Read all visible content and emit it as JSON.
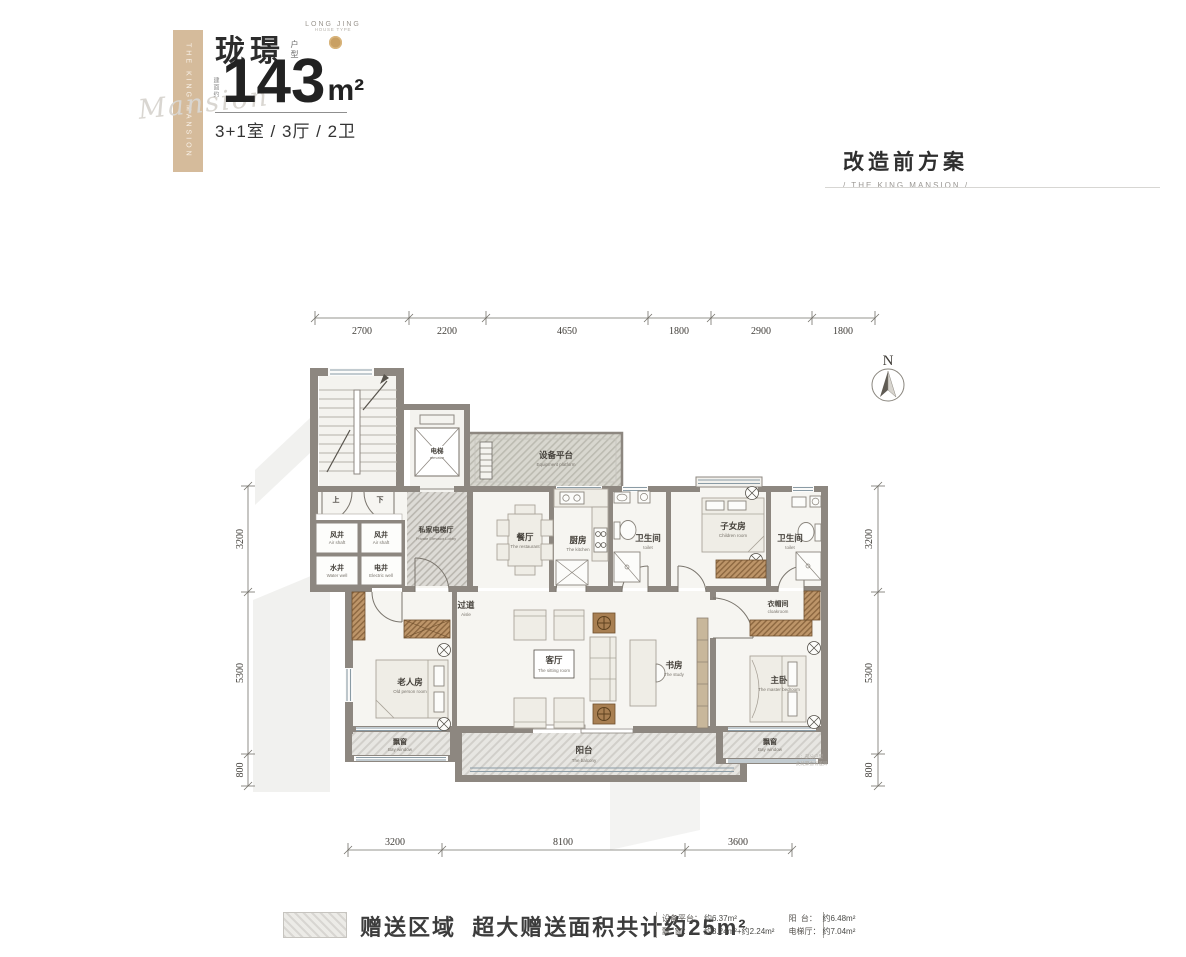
{
  "header": {
    "brand": "珑璟",
    "brand_tag": "户型",
    "area_prefix": "建面约",
    "area": "143",
    "area_unit": "m²",
    "layout": "3+1室 / 3厅 / 2卫",
    "logo_line1": "LONG JING",
    "logo_line2": "HOUSE TYPE",
    "ribbon_text": "THE KING MANSION",
    "script_text": "Mansion",
    "accent_color": "#d5bb9b",
    "gold_color": "#c9a063"
  },
  "title": {
    "main": "改造前方案",
    "sub": "/ THE KING MANSION /"
  },
  "north_label": "N",
  "dimensions": {
    "top": [
      "2700",
      "2200",
      "4650",
      "1800",
      "2900",
      "1800"
    ],
    "bottom": [
      "3200",
      "8100",
      "3600"
    ],
    "left": [
      "3200",
      "5300",
      "800"
    ],
    "right": [
      "3200",
      "5300",
      "800"
    ]
  },
  "rooms": {
    "air_shaft_1": {
      "zh": "风井",
      "en": "Air shaft"
    },
    "air_shaft_2": {
      "zh": "风井",
      "en": "Air shaft"
    },
    "water_well": {
      "zh": "水井",
      "en": "Water well"
    },
    "electric_well": {
      "zh": "电井",
      "en": "Electric well"
    },
    "elevator": {
      "zh": "电梯",
      "en": "elevator"
    },
    "lobby": {
      "zh": "私家电梯厅",
      "en": "Private Elevator Lobby"
    },
    "equipment": {
      "zh": "设备平台",
      "en": "Equipment platform"
    },
    "dining": {
      "zh": "餐厅",
      "en": "The restaurant"
    },
    "kitchen": {
      "zh": "厨房",
      "en": "The kitchen"
    },
    "bath_1": {
      "zh": "卫生间",
      "en": "toilet"
    },
    "children": {
      "zh": "子女房",
      "en": "Children room"
    },
    "bath_2": {
      "zh": "卫生间",
      "en": "toilet"
    },
    "aisle": {
      "zh": "过道",
      "en": "Aisle"
    },
    "old_person": {
      "zh": "老人房",
      "en": "Old person room"
    },
    "living": {
      "zh": "客厅",
      "en": "The sitting room"
    },
    "study": {
      "zh": "书房",
      "en": "The study"
    },
    "cloakroom": {
      "zh": "衣帽间",
      "en": "cloakroom"
    },
    "master": {
      "zh": "主卧",
      "en": "The master bedroom"
    },
    "bay_left": {
      "zh": "飘窗",
      "en": "Bay window"
    },
    "bay_right": {
      "zh": "飘窗",
      "en": "Bay window"
    },
    "balcony": {
      "zh": "阳台",
      "en": "The balcony"
    },
    "stair_up": "上",
    "stair_down": "下"
  },
  "plan_note": {
    "line1": "※：部分户型",
    "line2": "此处飘窗有差异"
  },
  "legend": {
    "text": "赠送区域  超大赠送面积共计约25m²"
  },
  "notes": {
    "item1_label": "设备平台：",
    "item1_value": "约6.37m²",
    "item2_label": "阳  台：",
    "item2_value": "约6.48m²",
    "item3_label": "飘  窗：",
    "item3_value": "约3.24m²+约2.24m²",
    "item4_label": "电梯厅：",
    "item4_value": "约7.04m²"
  }
}
